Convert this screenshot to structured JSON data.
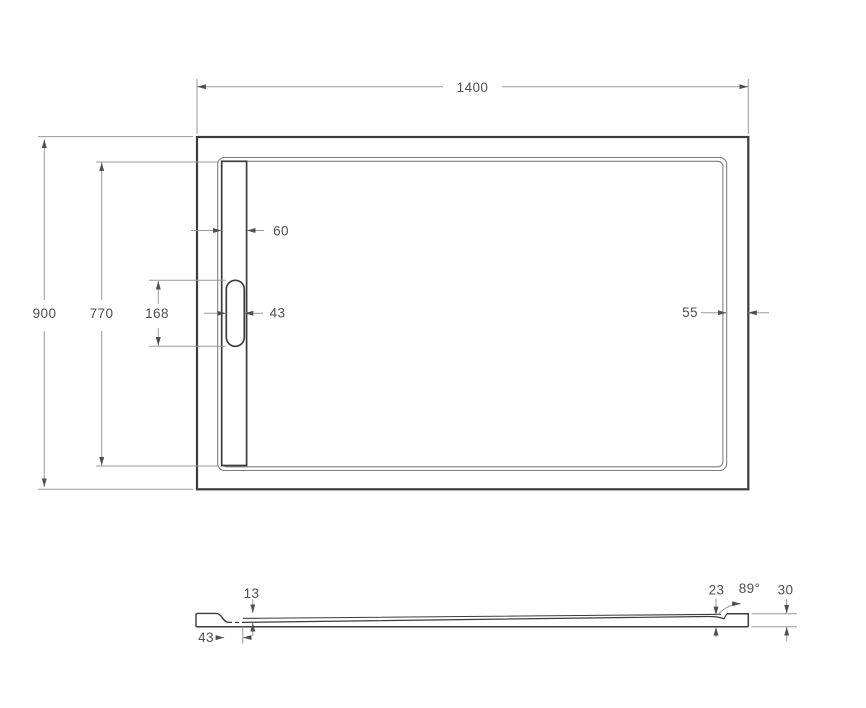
{
  "drawing": {
    "type": "technical-drawing",
    "subject": "rectangular shower tray with linear drain",
    "views": {
      "top_view": "top-view",
      "side_view": "side-profile-view"
    }
  },
  "dimensions": {
    "top": {
      "overall_width": "1400",
      "overall_depth": "900",
      "inner_depth": "770",
      "drain_channel_width": "60",
      "drain_slot_length": "168",
      "drain_slot_width": "43",
      "right_rim_width": "55"
    },
    "side": {
      "drain_recess_depth": "13",
      "drain_recess_width": "43",
      "floor_edge_thickness": "23",
      "wall_angle": "89°",
      "overall_height": "30"
    }
  },
  "colors": {
    "outline": "#3c3c3c",
    "rim_line": "#7c7c7c",
    "dimension_line": "#9a9a9a",
    "dimension_text": "#4f4f4f",
    "background": "#ffffff"
  }
}
